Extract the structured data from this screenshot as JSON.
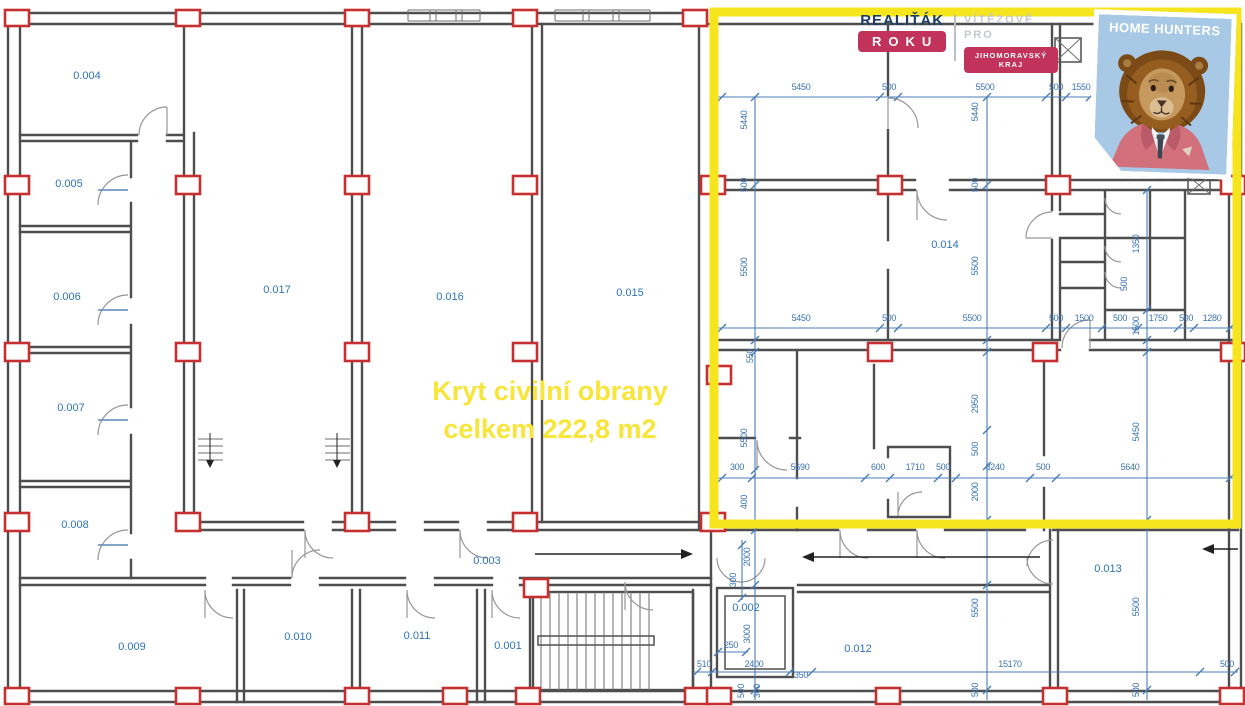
{
  "plan": {
    "annotation": {
      "line1": "Kryt civilní obrany",
      "line2": "celkem 222,8 m2"
    },
    "rooms": [
      {
        "label": "0.001"
      },
      {
        "label": "0.002"
      },
      {
        "label": "0.003"
      },
      {
        "label": "0.004"
      },
      {
        "label": "0.005"
      },
      {
        "label": "0.006"
      },
      {
        "label": "0.007"
      },
      {
        "label": "0.008"
      },
      {
        "label": "0.009"
      },
      {
        "label": "0.010"
      },
      {
        "label": "0.011"
      },
      {
        "label": "0.012"
      },
      {
        "label": "0.013"
      },
      {
        "label": "0.014"
      },
      {
        "label": "0.015"
      },
      {
        "label": "0.016"
      },
      {
        "label": "0.017"
      }
    ],
    "dims": {
      "row_a": [
        "5450",
        "500",
        "5500",
        "500",
        "1550"
      ],
      "row_b": [
        "5450",
        "500",
        "5500",
        "500",
        "1500",
        "500",
        "1750",
        "500",
        "1280"
      ],
      "row_c": [
        "300",
        "5690",
        "600",
        "1710",
        "500",
        "3240",
        "500",
        "5640"
      ],
      "row_d": [
        "250",
        "510",
        "2400",
        "350",
        "15170",
        "500"
      ],
      "col_a": [
        "5440",
        "500",
        "5500",
        "550",
        "5500",
        "400",
        "2000",
        "300",
        "3000",
        "500",
        "300"
      ],
      "col_b": [
        "5440",
        "500",
        "5500",
        "2950",
        "500",
        "2000",
        "5500",
        "500"
      ],
      "col_c": [
        "1350",
        "500",
        "1500",
        "5450",
        "5500",
        "500"
      ]
    }
  },
  "branding": {
    "realitak": {
      "name": "REALIŤÁK",
      "name2": "ROKU",
      "tagline1": "VÍTĚZOVÉ PRO",
      "tagline2": "JIHOMORAVSKÝ KRAJ"
    },
    "home_hunters": {
      "name": "HOME HUNTERS"
    }
  },
  "colors": {
    "highlight_yellow": "#f6e41c",
    "annotation_yellow": "#f8e53a",
    "dimension_blue": "#4a7db8",
    "room_label_blue": "#2e74b8",
    "column_red": "#c63030",
    "badge_crimson": "#c1335a",
    "card_blue": "#a7c9e6",
    "wall_gray": "#4e4e4e"
  }
}
